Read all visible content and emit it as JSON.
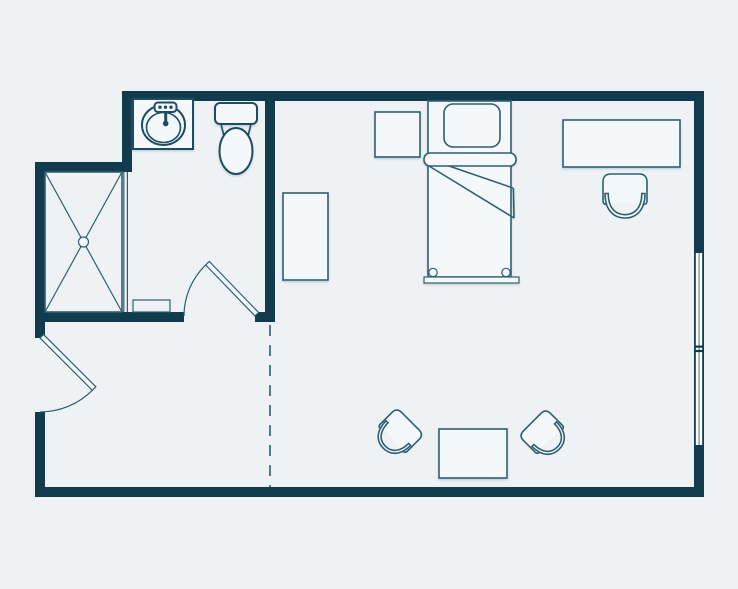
{
  "diagram": {
    "type": "floor-plan",
    "rooms": [
      "bathroom",
      "bedroom-living-area"
    ],
    "elements": [
      "top-wall",
      "right-wall",
      "bottom-wall",
      "left-wall",
      "bathroom-left-wall",
      "bathroom-step-wall",
      "bathroom-right-wall",
      "bathroom-bottom-wall",
      "window-right",
      "entry-door",
      "bathroom-door",
      "room-divider-dashed-line",
      "shower",
      "shower-glass-panel",
      "shower-threshold",
      "vanity",
      "sink",
      "faucet",
      "toilet",
      "dresser",
      "nightstand",
      "bed",
      "pillow",
      "blanket-band",
      "blanket-fold",
      "footboard",
      "desk",
      "desk-chair",
      "armchair-left",
      "armchair-right",
      "coffee-table"
    ]
  },
  "colors": {
    "bg": "#eef2f5",
    "wall": "#123b4d",
    "line": "#2d5f70",
    "lined": "#1e4d60",
    "glass": "#8fa9b4",
    "fill": "#f5f8fa",
    "winfill": "#fbfdfe"
  }
}
